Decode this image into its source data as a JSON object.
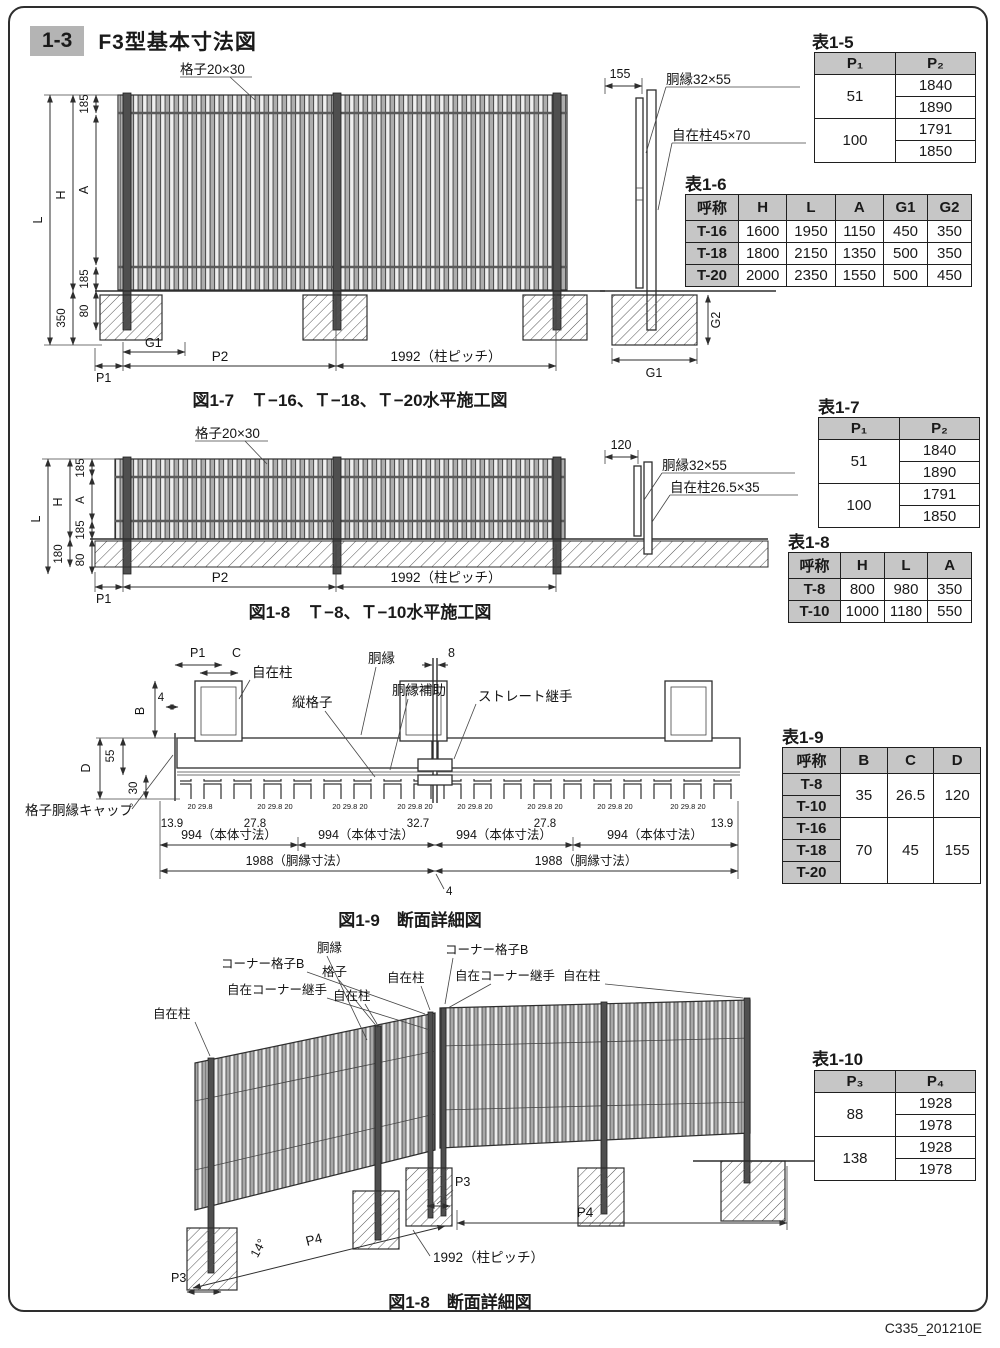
{
  "page": {
    "section_no": "1-3",
    "title": "F3型基本寸法図",
    "doc_code": "C335_201210E"
  },
  "fig17": {
    "caption": "図1-7　Ｔ−16、Ｔ−18、Ｔ−20水平施工図",
    "lattice": "格子20×30",
    "L": "L",
    "H": "H",
    "A": "A",
    "t185": "185",
    "b185": "185",
    "v350": "350",
    "v80": "80",
    "P1": "P1",
    "G1": "G1",
    "P2": "P2",
    "pitch": "1992（柱ピッチ）",
    "side_w": "155",
    "side_rail": "胴縁32×55",
    "side_post": "自在柱45×70",
    "G2": "G2"
  },
  "fig18": {
    "caption": "図1-8　Ｔ−8、Ｔ−10水平施工図",
    "lattice": "格子20×30",
    "L": "L",
    "H": "H",
    "A": "A",
    "t185": "185",
    "b185": "185",
    "v180": "180",
    "v80": "80",
    "P1": "P1",
    "P2": "P2",
    "pitch": "1992（柱ピッチ）",
    "side_w": "120",
    "side_rail": "胴縁32×55",
    "side_post": "自在柱26.5×35"
  },
  "fig19": {
    "caption": "図1-9　断面詳細図",
    "P1": "P1",
    "C": "C",
    "n4": "4",
    "post": "自在柱",
    "rail": "胴縁",
    "vlat": "縦格子",
    "railaux": "胴縁補助",
    "n8": "8",
    "joint": "ストレート継手",
    "B": "B",
    "D": "D",
    "n55": "55",
    "n30": "30",
    "cap": "格子胴縁キャップ",
    "mini1": "20 29.8",
    "mini": "20 29.8 20",
    "e139": "13.9",
    "m278": "27.8",
    "c327": "32.7",
    "body": "994（本体寸法）",
    "raildim": "1988（胴縁寸法）",
    "gap4": "4"
  },
  "fig18b": {
    "caption": "図1-8　断面詳細図",
    "post": "自在柱",
    "corner_lat": "コーナー格子B",
    "corner_joint": "自在コーナー継手",
    "rail": "胴縁",
    "lat": "格子",
    "P3": "P3",
    "P4": "P4",
    "angle": "14°",
    "pitch": "1992（柱ピッチ）"
  },
  "tables": {
    "t5": {
      "title": "表1-5",
      "h1": "P₁",
      "h2": "P₂",
      "r1a": "51",
      "r1b1": "1840",
      "r1b2": "1890",
      "r2a": "100",
      "r2b1": "1791",
      "r2b2": "1850"
    },
    "t6": {
      "title": "表1-6",
      "headers": [
        "呼称",
        "H",
        "L",
        "A",
        "G1",
        "G2"
      ],
      "rows": [
        [
          "T-16",
          "1600",
          "1950",
          "1150",
          "450",
          "350"
        ],
        [
          "T-18",
          "1800",
          "2150",
          "1350",
          "500",
          "350"
        ],
        [
          "T-20",
          "2000",
          "2350",
          "1550",
          "500",
          "450"
        ]
      ]
    },
    "t7": {
      "title": "表1-7",
      "h1": "P₁",
      "h2": "P₂",
      "r1a": "51",
      "r1b1": "1840",
      "r1b2": "1890",
      "r2a": "100",
      "r2b1": "1791",
      "r2b2": "1850"
    },
    "t8": {
      "title": "表1-8",
      "headers": [
        "呼称",
        "H",
        "L",
        "A"
      ],
      "rows": [
        [
          "T-8",
          "800",
          "980",
          "350"
        ],
        [
          "T-10",
          "1000",
          "1180",
          "550"
        ]
      ]
    },
    "t9": {
      "title": "表1-9",
      "headers": [
        "呼称",
        "B",
        "C",
        "D"
      ],
      "g1_names": [
        "T-8",
        "T-10"
      ],
      "g1": [
        "35",
        "26.5",
        "120"
      ],
      "g2_names": [
        "T-16",
        "T-18",
        "T-20"
      ],
      "g2": [
        "70",
        "45",
        "155"
      ]
    },
    "t10": {
      "title": "表1-10",
      "h1": "P₃",
      "h2": "P₄",
      "r1a": "88",
      "r1b1": "1928",
      "r1b2": "1978",
      "r2a": "138",
      "r2b1": "1928",
      "r2b2": "1978"
    }
  }
}
